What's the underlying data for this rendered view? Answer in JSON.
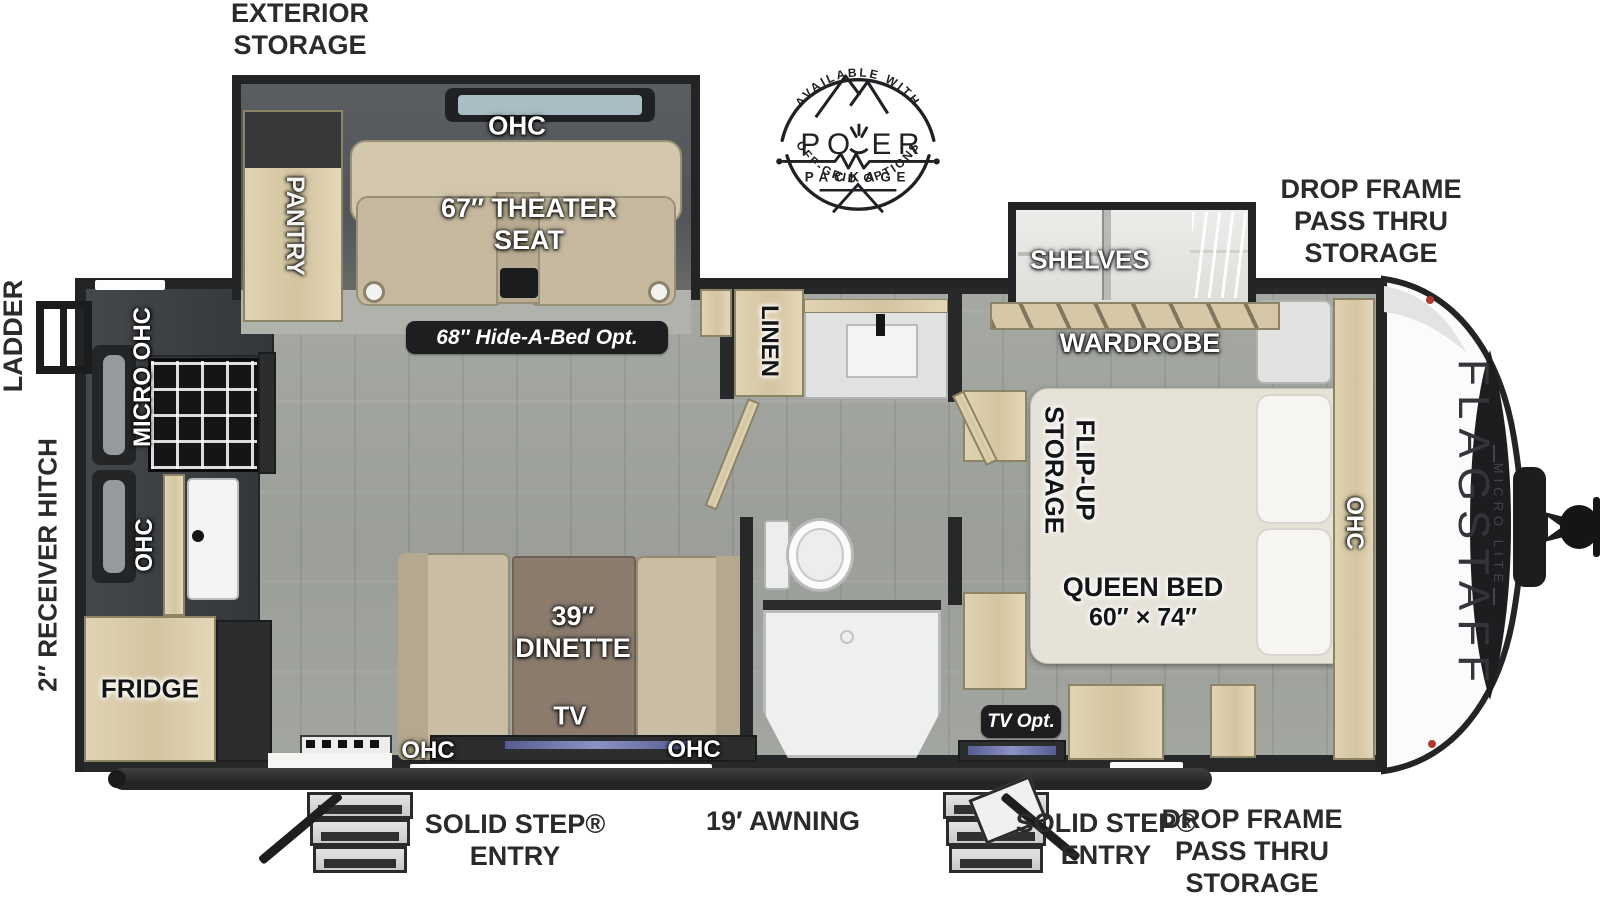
{
  "title": "Flagstaff Micro Lite travel trailer floor plan",
  "colors": {
    "wall": "#232426",
    "floor": "#a1a49f",
    "wood": "#d9cba9",
    "counter": "#3b3e41",
    "seat_tan": "#c8bca3",
    "bed_cream": "#e6e2d8",
    "table_brown": "#8b7c6e",
    "pill_bg": "#1d1e20",
    "tv_screen": "#6f74a8",
    "label_dark": "#2b2b2e"
  },
  "branding": {
    "model": "FLAGSTAFF",
    "series": "MICRO LITE"
  },
  "badge": {
    "available_with": "AVAILABLE WITH",
    "power_left": "PO",
    "power_right": "ER",
    "package": "PACKAGE",
    "off_grid": "OFF-GRID OPTIONS"
  },
  "exterior": {
    "exterior_storage": "EXTERIOR\nSTORAGE",
    "drop_frame_top": "DROP FRAME\nPASS THRU\nSTORAGE",
    "drop_frame_bottom": "DROP FRAME\nPASS THRU\nSTORAGE",
    "ladder": "LADDER",
    "receiver_hitch": "2″ RECEIVER HITCH",
    "solid_step_left": "SOLID STEP®\nENTRY",
    "solid_step_right": "SOLID STEP®\nENTRY",
    "awning": "19′ AWNING"
  },
  "interior": {
    "pantry": "PANTRY",
    "ohc_slide": "OHC",
    "theater_seat": "67″ THEATER\nSEAT",
    "hide_a_bed": "68″ Hide-A-Bed Opt.",
    "micro_ohc": "MICRO OHC",
    "ohc_kitchen": "OHC",
    "fridge": "FRIDGE",
    "dinette": "39″\nDINETTE",
    "tv": "TV",
    "ohc_door_left": "OHC",
    "ohc_door_right": "OHC",
    "linen": "LINEN",
    "shelves": "SHELVES",
    "wardrobe": "WARDROBE",
    "flip_up_storage": "FLIP-UP\nSTORAGE",
    "queen_bed": "QUEEN BED",
    "queen_bed_size": "60″ × 74″",
    "ohc_bed": "OHC",
    "tv_opt": "TV Opt."
  }
}
